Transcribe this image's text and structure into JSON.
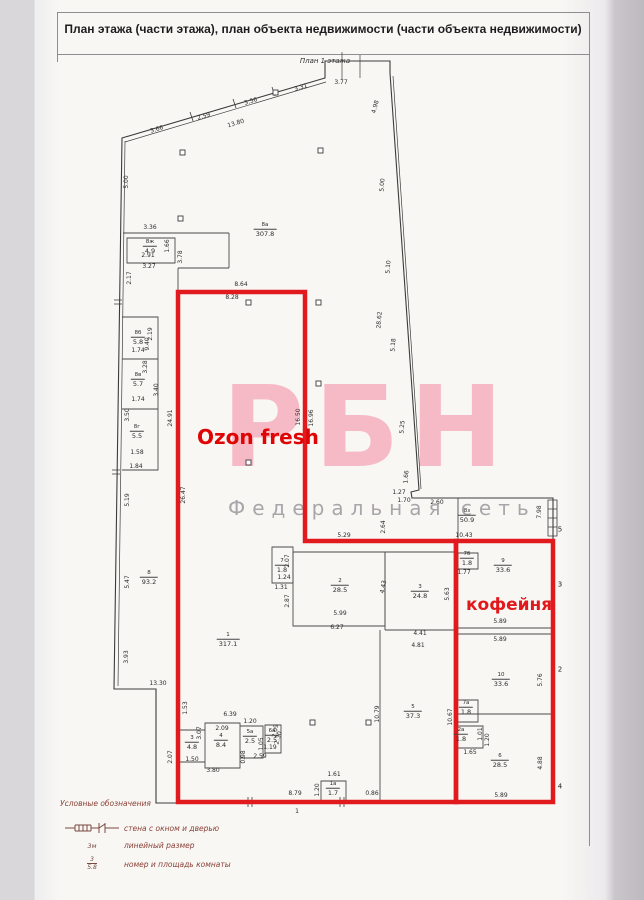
{
  "page": {
    "title": "План этажа (части этажа), план объекта недвижимости (части объекта недвижимости)",
    "plan_caption": "План 1 этажа"
  },
  "watermark": {
    "big": "РБН",
    "small": "Федеральная сеть"
  },
  "zones": {
    "ozon": "Ozon fresh",
    "cafe": "кофейня"
  },
  "colors": {
    "red_outline": "#e01a1d",
    "watermark_pink": "#f6bac6",
    "watermark_gray": "#a9a6aa",
    "line": "#3c3c3c",
    "legend_text": "#8b4137"
  },
  "legend": {
    "title": "Условные обозначения",
    "wall_label": "стена с окном и дверью",
    "linear_symbol": "3м",
    "linear_label": "линейный размер",
    "room_symbol_num": "3",
    "room_symbol_area": "5.8",
    "room_label": "номер и площадь комнаты"
  },
  "plan": {
    "dims": [
      {
        "t": "3.66",
        "x": 157,
        "y": 130,
        "r": -17
      },
      {
        "t": "2.59",
        "x": 204,
        "y": 117,
        "r": -17
      },
      {
        "t": "13.80",
        "x": 236,
        "y": 124,
        "r": -17
      },
      {
        "t": "3.56",
        "x": 251,
        "y": 102,
        "r": -17
      },
      {
        "t": "3.31",
        "x": 301,
        "y": 88,
        "r": -17
      },
      {
        "t": "3.77",
        "x": 341,
        "y": 83
      },
      {
        "t": "4.98",
        "x": 376,
        "y": 107,
        "r": -75
      },
      {
        "t": "5.00",
        "x": 127,
        "y": 182,
        "r": -90
      },
      {
        "t": "5.00",
        "x": 383,
        "y": 185,
        "r": -86
      },
      {
        "t": "5.10",
        "x": 389,
        "y": 267,
        "r": -86
      },
      {
        "t": "28.62",
        "x": 380,
        "y": 320,
        "r": -86
      },
      {
        "t": "5.18",
        "x": 394,
        "y": 345,
        "r": -86
      },
      {
        "t": "5.25",
        "x": 403,
        "y": 427,
        "r": -86
      },
      {
        "t": "1.66",
        "x": 407,
        "y": 477,
        "r": -86
      },
      {
        "t": "1.27",
        "x": 399,
        "y": 493
      },
      {
        "t": "1.70",
        "x": 404,
        "y": 501
      },
      {
        "t": "2.60",
        "x": 437,
        "y": 503
      },
      {
        "t": "7.98",
        "x": 540,
        "y": 512,
        "r": -90
      },
      {
        "t": "2.64",
        "x": 384,
        "y": 527,
        "r": -90
      },
      {
        "t": "10.43",
        "x": 464,
        "y": 536
      },
      {
        "t": "3.36",
        "x": 150,
        "y": 228
      },
      {
        "t": "1.66",
        "x": 168,
        "y": 246,
        "r": -90
      },
      {
        "t": "2.91",
        "x": 148,
        "y": 256
      },
      {
        "t": "3.27",
        "x": 149,
        "y": 267
      },
      {
        "t": "3.78",
        "x": 181,
        "y": 257,
        "r": -90
      },
      {
        "t": "2.17",
        "x": 130,
        "y": 278,
        "r": -90
      },
      {
        "t": "2.19",
        "x": 151,
        "y": 334,
        "r": -90
      },
      {
        "t": "9.40",
        "x": 148,
        "y": 344,
        "r": -90
      },
      {
        "t": "1.74",
        "x": 138,
        "y": 351
      },
      {
        "t": "3.28",
        "x": 146,
        "y": 367,
        "r": -90
      },
      {
        "t": "3.40",
        "x": 157,
        "y": 390,
        "r": -90
      },
      {
        "t": "1.74",
        "x": 138,
        "y": 400
      },
      {
        "t": "3.50",
        "x": 128,
        "y": 415,
        "r": -90
      },
      {
        "t": "1.58",
        "x": 137,
        "y": 453
      },
      {
        "t": "1.84",
        "x": 136,
        "y": 467
      },
      {
        "t": "5.19",
        "x": 128,
        "y": 500,
        "r": -90
      },
      {
        "t": "5.47",
        "x": 128,
        "y": 582,
        "r": -90
      },
      {
        "t": "3.93",
        "x": 127,
        "y": 657,
        "r": -90
      },
      {
        "t": "13.30",
        "x": 158,
        "y": 684
      },
      {
        "t": "24.91",
        "x": 171,
        "y": 418,
        "r": -90
      },
      {
        "t": "26.47",
        "x": 184,
        "y": 495,
        "r": -90
      },
      {
        "t": "8.64",
        "x": 241,
        "y": 285
      },
      {
        "t": "8.28",
        "x": 232,
        "y": 298
      },
      {
        "t": "16.50",
        "x": 299,
        "y": 417,
        "r": -90
      },
      {
        "t": "16.96",
        "x": 312,
        "y": 418,
        "r": -90
      },
      {
        "t": "5.29",
        "x": 344,
        "y": 536
      },
      {
        "t": "2.07",
        "x": 288,
        "y": 561,
        "r": -90
      },
      {
        "t": "1.24",
        "x": 284,
        "y": 578
      },
      {
        "t": "1.31",
        "x": 281,
        "y": 588
      },
      {
        "t": "2.87",
        "x": 288,
        "y": 601,
        "r": -90
      },
      {
        "t": "5.99",
        "x": 340,
        "y": 614
      },
      {
        "t": "6.27",
        "x": 337,
        "y": 628
      },
      {
        "t": "4.43",
        "x": 384,
        "y": 587,
        "r": -80
      },
      {
        "t": "5.63",
        "x": 448,
        "y": 594,
        "r": -90
      },
      {
        "t": "4.41",
        "x": 420,
        "y": 634
      },
      {
        "t": "4.81",
        "x": 418,
        "y": 646
      },
      {
        "t": "1.77",
        "x": 464,
        "y": 573
      },
      {
        "t": "5.89",
        "x": 500,
        "y": 622
      },
      {
        "t": "5.89",
        "x": 500,
        "y": 640
      },
      {
        "t": "5.76",
        "x": 541,
        "y": 680,
        "r": -90
      },
      {
        "t": "10.79",
        "x": 378,
        "y": 714,
        "r": -90
      },
      {
        "t": "10.67",
        "x": 451,
        "y": 717,
        "r": -90
      },
      {
        "t": "1.65",
        "x": 470,
        "y": 753
      },
      {
        "t": "1.01",
        "x": 481,
        "y": 734,
        "r": -90
      },
      {
        "t": "1.20",
        "x": 488,
        "y": 740,
        "r": -90
      },
      {
        "t": "4.88",
        "x": 541,
        "y": 763,
        "r": -90
      },
      {
        "t": "5.89",
        "x": 501,
        "y": 796
      },
      {
        "t": "1.53",
        "x": 186,
        "y": 708,
        "r": -90
      },
      {
        "t": "6.39",
        "x": 230,
        "y": 715
      },
      {
        "t": "2.09",
        "x": 222,
        "y": 729
      },
      {
        "t": "1.20",
        "x": 250,
        "y": 722
      },
      {
        "t": "2.09",
        "x": 276,
        "y": 731,
        "r": -80
      },
      {
        "t": "3.07",
        "x": 200,
        "y": 733,
        "r": -90
      },
      {
        "t": "1.50",
        "x": 192,
        "y": 760
      },
      {
        "t": "3.80",
        "x": 213,
        "y": 771
      },
      {
        "t": "1.05",
        "x": 262,
        "y": 744,
        "r": -90
      },
      {
        "t": "0.98",
        "x": 244,
        "y": 757,
        "r": -90
      },
      {
        "t": "2.59",
        "x": 260,
        "y": 757
      },
      {
        "t": "1.19",
        "x": 270,
        "y": 748
      },
      {
        "t": "2.30",
        "x": 279,
        "y": 738,
        "r": -75
      },
      {
        "t": "2.07",
        "x": 171,
        "y": 757,
        "r": -90
      },
      {
        "t": "8.79",
        "x": 295,
        "y": 794
      },
      {
        "t": "1",
        "x": 297,
        "y": 812
      },
      {
        "t": "1.61",
        "x": 334,
        "y": 775
      },
      {
        "t": "1.20",
        "x": 318,
        "y": 790,
        "r": -90
      },
      {
        "t": "0.86",
        "x": 372,
        "y": 794
      }
    ],
    "sides": [
      {
        "t": "5",
        "x": 560,
        "y": 530
      },
      {
        "t": "3",
        "x": 560,
        "y": 585
      },
      {
        "t": "2",
        "x": 560,
        "y": 670
      },
      {
        "t": "4",
        "x": 560,
        "y": 787
      }
    ],
    "rooms": [
      {
        "num": "8а",
        "area": "307.8",
        "x": 265,
        "y": 230
      },
      {
        "num": "8ж",
        "area": "4.9",
        "x": 150,
        "y": 247
      },
      {
        "num": "8б",
        "area": "5.8",
        "x": 138,
        "y": 338
      },
      {
        "num": "8в",
        "area": "5.7",
        "x": 138,
        "y": 380
      },
      {
        "num": "8г",
        "area": "5.5",
        "x": 137,
        "y": 432
      },
      {
        "num": "8",
        "area": "93.2",
        "x": 149,
        "y": 578
      },
      {
        "num": "1",
        "area": "317.1",
        "x": 228,
        "y": 640
      },
      {
        "num": "7",
        "area": "1.8",
        "x": 282,
        "y": 566
      },
      {
        "num": "2",
        "area": "28.5",
        "x": 340,
        "y": 586
      },
      {
        "num": "3",
        "area": "24.8",
        "x": 420,
        "y": 592
      },
      {
        "num": "8з",
        "area": "50.9",
        "x": 467,
        "y": 516
      },
      {
        "num": "7б",
        "area": "1.8",
        "x": 467,
        "y": 559
      },
      {
        "num": "9",
        "area": "33.6",
        "x": 503,
        "y": 566
      },
      {
        "num": "10",
        "area": "33.6",
        "x": 501,
        "y": 680
      },
      {
        "num": "5",
        "area": "37.3",
        "x": 413,
        "y": 712
      },
      {
        "num": "6",
        "area": "28.5",
        "x": 500,
        "y": 761
      },
      {
        "num": "7а",
        "area": "1.8",
        "x": 466,
        "y": 708
      },
      {
        "num": "2а",
        "area": "1.8",
        "x": 461,
        "y": 735
      },
      {
        "num": "3",
        "area": "4.8",
        "x": 192,
        "y": 743
      },
      {
        "num": "4",
        "area": "8.4",
        "x": 221,
        "y": 741
      },
      {
        "num": "5а",
        "area": "2.5",
        "x": 250,
        "y": 737
      },
      {
        "num": "6а",
        "area": "2.5",
        "x": 272,
        "y": 736
      },
      {
        "num": "1а",
        "area": "1.7",
        "x": 333,
        "y": 789
      }
    ]
  }
}
